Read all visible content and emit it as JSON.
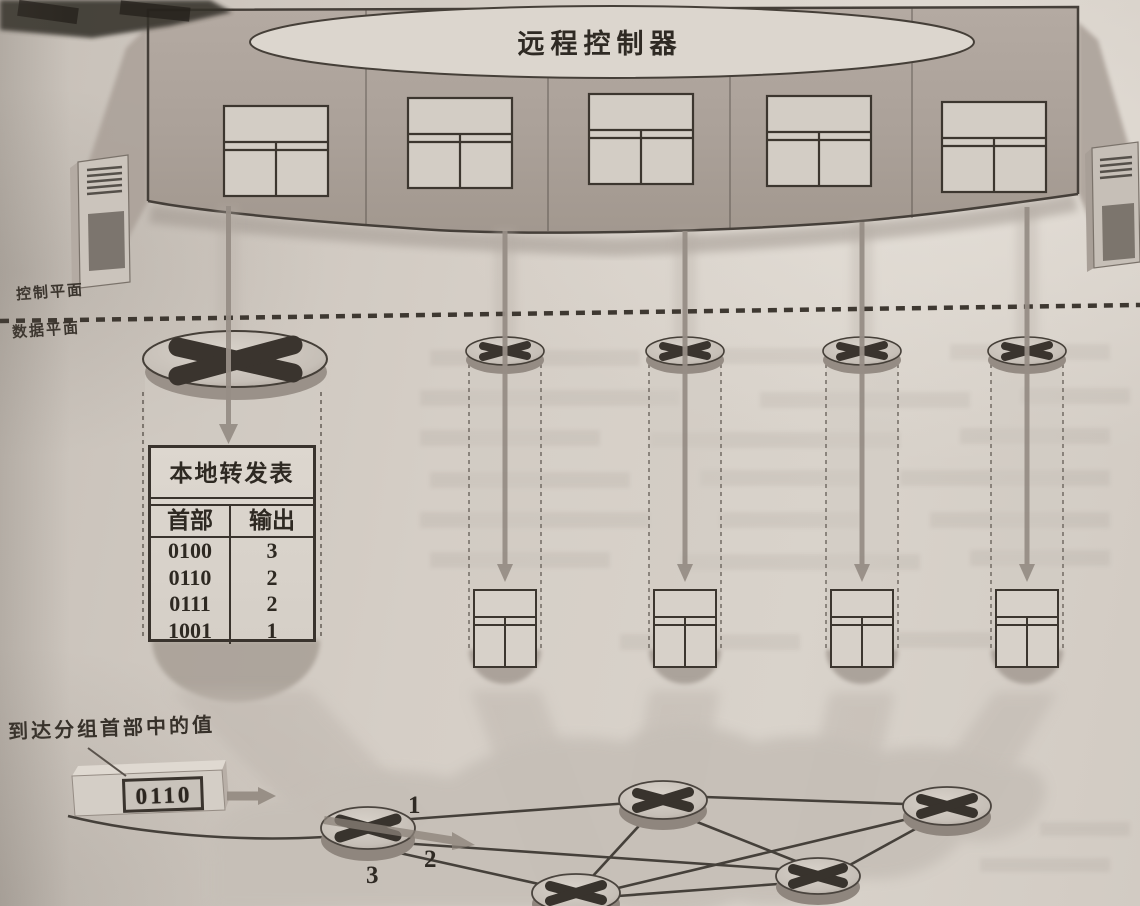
{
  "controller": {
    "label": "远程控制器"
  },
  "planes": {
    "control_label": "控制平面",
    "data_label": "数据平面"
  },
  "forwarding_table": {
    "title": "本地转发表",
    "header_col": "首部",
    "output_col": "输出",
    "rows": [
      {
        "header": "0100",
        "output": "3"
      },
      {
        "header": "0110",
        "output": "2"
      },
      {
        "header": "0111",
        "output": "2"
      },
      {
        "header": "1001",
        "output": "1"
      }
    ]
  },
  "packet": {
    "label": "到达分组首部中的值",
    "value": "0110"
  },
  "port_labels": {
    "p1": "1",
    "p2": "2",
    "p3": "3"
  },
  "colors": {
    "ink": "#332d27",
    "band_gray": "#aea49c",
    "paper": "#d5cec6",
    "shaft_gray": "#978e86",
    "table_fill": "#d8d2ca"
  },
  "icons": [
    "router-icon",
    "forwarding-table-icon",
    "server-tower-icon",
    "down-arrow-icon",
    "right-arrow-icon",
    "packet-icon"
  ]
}
